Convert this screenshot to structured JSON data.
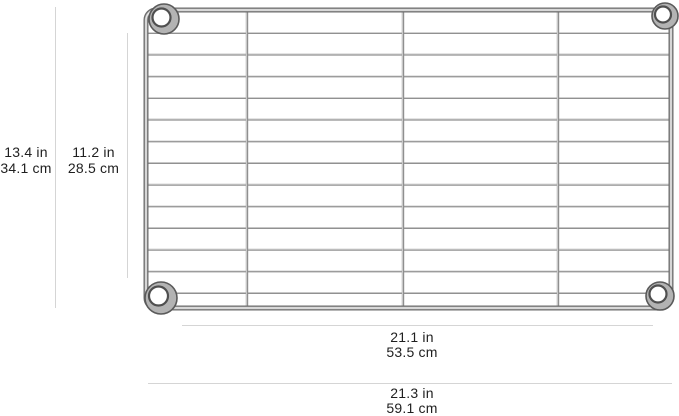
{
  "graphics": {
    "shelf": "chrome-wire-shelf-top-view"
  },
  "dimension_labels": {
    "overall_height": {
      "inches": "13.4 in",
      "centimeters": "34.1 cm"
    },
    "inner_height": {
      "inches": "11.2 in",
      "centimeters": "28.5 cm"
    },
    "inner_width": {
      "inches": "21.1 in",
      "centimeters": "53.5 cm"
    },
    "overall_width": {
      "inches": "21.3 in",
      "centimeters": "59.1 cm"
    }
  },
  "colors": {
    "background": "#ffffff",
    "dimension_line": "#d5d5d5",
    "label_text": "#1f1f1f",
    "chrome_wire": "#919191",
    "chrome_frame_dark": "#6c6c6c",
    "chrome_highlight": "#e8e8e8",
    "collar_ring_dark": "#4f4f4f",
    "collar_body": "#b3b3b3"
  }
}
